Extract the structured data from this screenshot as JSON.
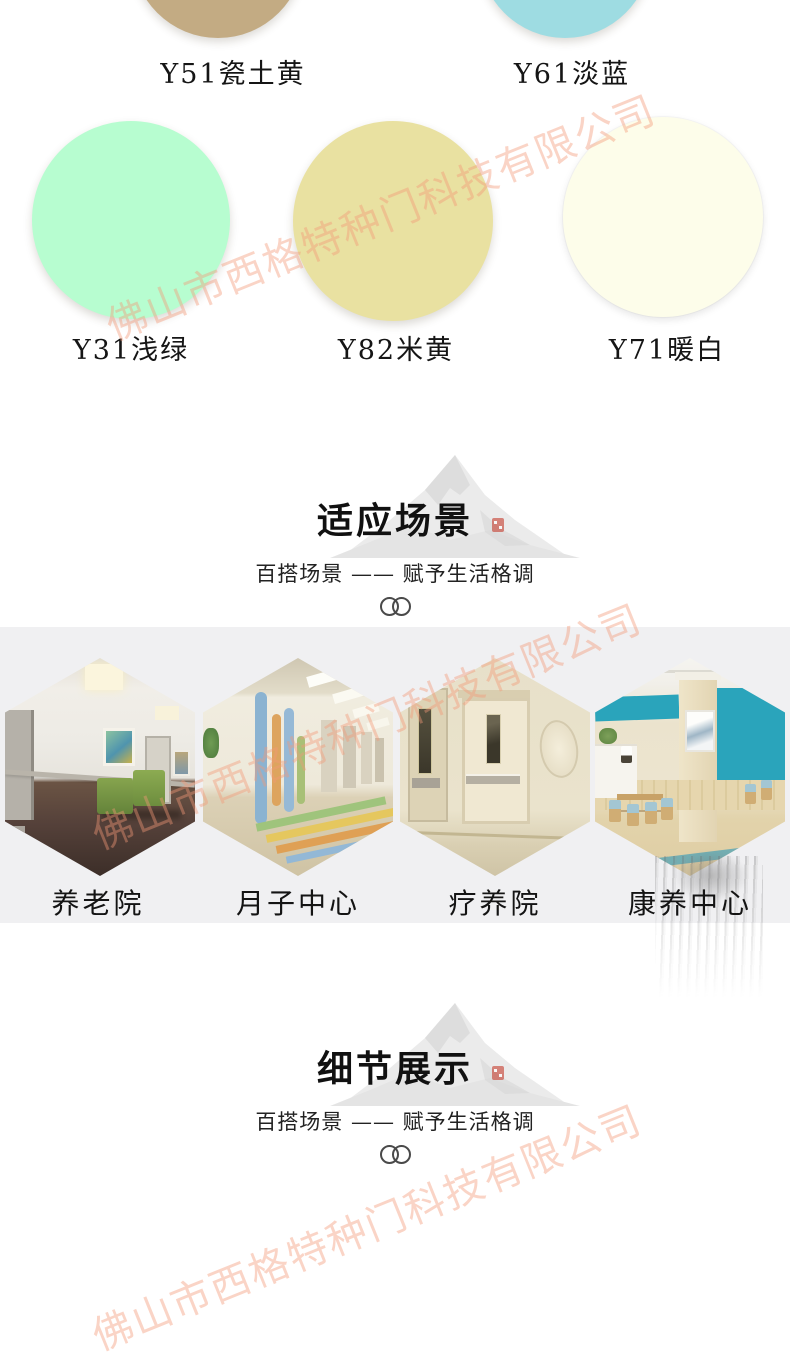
{
  "watermark": {
    "text": "佛山市西格特种门科技有限公司",
    "color": "#f39878",
    "opacity": "0.42"
  },
  "swatches": {
    "row1": [
      {
        "label": "Y51瓷土黄",
        "color": "#c3ab83"
      },
      {
        "label": "Y61淡蓝",
        "color": "#9edce2"
      }
    ],
    "row2": [
      {
        "label": "Y31浅绿",
        "color": "#b7fdd0"
      },
      {
        "label": "Y82米黄",
        "color": "#e9e1a1"
      },
      {
        "label": "Y71暖白",
        "color": "#fdfdea"
      }
    ]
  },
  "sections": {
    "scenes": {
      "title": "适应场景",
      "subtitle": "百搭场景 —— 赋予生活格调"
    },
    "details": {
      "title": "细节展示",
      "subtitle": "百搭场景 —— 赋予生活格调"
    }
  },
  "scenes": {
    "items": [
      {
        "label": "养老院"
      },
      {
        "label": "月子中心"
      },
      {
        "label": "疗养院"
      },
      {
        "label": "康养中心"
      }
    ]
  },
  "colors": {
    "band_background": "#f0f0f2",
    "accent_teal": "#2aa4bb",
    "seal_red": "#c53b2d",
    "text_dark": "#1c1c1c"
  }
}
